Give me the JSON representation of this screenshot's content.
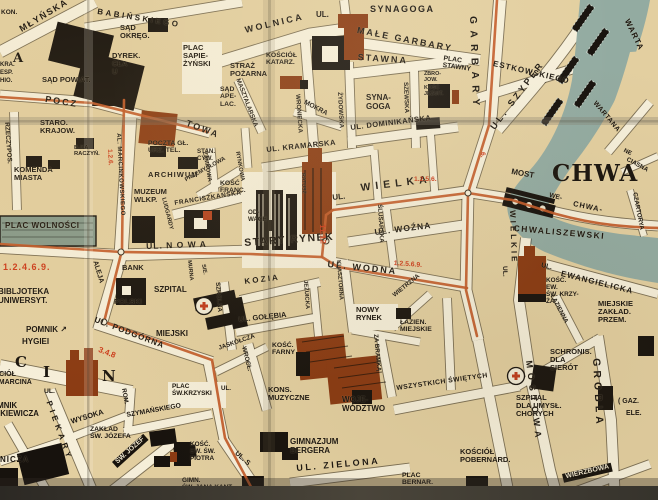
{
  "map": {
    "palette": {
      "paper_block": "#e3cfa0",
      "street": "#f6efda",
      "water": "#93aba1",
      "building_black": "#17120d",
      "landmark_red": "#8a3a12",
      "tram_line_orange": "#c25a28",
      "route_number_red": "#cd3b1a",
      "plac_wolnosci_fill": "#87998a"
    },
    "labels": [
      {
        "t": "KON.",
        "x": 1,
        "y": 9,
        "s": 6.5
      },
      {
        "t": "MŁYŃSKA",
        "x": 18,
        "y": 26,
        "r": -31,
        "s": 9,
        "sp": 1.5
      },
      {
        "t": "BABIŃSKIEGO",
        "x": 98,
        "y": 8,
        "r": 9,
        "s": 8,
        "sp": 2.5
      },
      {
        "t": "A",
        "x": 13,
        "y": 52,
        "s": 13,
        "c": "serif"
      },
      {
        "t": "KRA.",
        "x": 0,
        "y": 62,
        "s": 6
      },
      {
        "t": "ESP.",
        "x": 0,
        "y": 70,
        "s": 6
      },
      {
        "t": "HIO.",
        "x": 0,
        "y": 78,
        "s": 6
      },
      {
        "t": "SĄD\nOKRĘG.",
        "x": 120,
        "y": 24,
        "s": 7.5
      },
      {
        "t": "DYREK.\nCŁA\nU",
        "x": 112,
        "y": 52,
        "s": 7.5
      },
      {
        "t": "PLAC\nSAPIE-\nŻYŃSKI",
        "x": 183,
        "y": 44,
        "s": 7.5
      },
      {
        "t": "SĄD POWIAT.",
        "x": 42,
        "y": 76,
        "s": 7.5
      },
      {
        "t": "POCZ",
        "x": 46,
        "y": 95,
        "r": 9,
        "s": 9,
        "sp": 2
      },
      {
        "t": "TOWA",
        "x": 188,
        "y": 119,
        "r": 21,
        "s": 9,
        "sp": 2
      },
      {
        "t": "RZECZYPOS.",
        "x": 10,
        "y": 122,
        "r": 86,
        "s": 6.5
      },
      {
        "t": "STARO.\nKRAJOW.",
        "x": 40,
        "y": 119,
        "s": 7.5
      },
      {
        "t": "B-KA\nRACZYŃ.",
        "x": 74,
        "y": 145,
        "s": 5.8
      },
      {
        "t": "KOMENDA\nMIASTA",
        "x": 14,
        "y": 166,
        "s": 7.5
      },
      {
        "t": "POCZTA GŁ.\nURZ. TEL.",
        "x": 148,
        "y": 140,
        "s": 6.8
      },
      {
        "t": "STAN.\nCYW.",
        "x": 197,
        "y": 149,
        "s": 6.2
      },
      {
        "t": "ARCHIWUM",
        "x": 148,
        "y": 171,
        "s": 7.5,
        "sp": 1
      },
      {
        "t": "MUZEUM\nWLKP.",
        "x": 134,
        "y": 188,
        "s": 7.5
      },
      {
        "t": "AL. MARCINKOWSKIEGO",
        "x": 121,
        "y": 133,
        "r": 87,
        "s": 6,
        "sp": 0.5
      },
      {
        "t": "1.2.6.",
        "x": 113,
        "y": 149,
        "r": 87,
        "s": 6.5,
        "c": "red"
      },
      {
        "t": "LUDGARDY",
        "x": 166,
        "y": 197,
        "r": 76,
        "s": 5.8
      },
      {
        "t": "ZAMKOWA",
        "x": 207,
        "y": 151,
        "r": 80,
        "s": 5.8
      },
      {
        "t": "RYNKOWA",
        "x": 240,
        "y": 151,
        "r": 80,
        "s": 5.8
      },
      {
        "t": "PRZEMYSŁOWA",
        "x": 184,
        "y": 178,
        "r": -29,
        "s": 5.8
      },
      {
        "t": "FRANCISZKAŃSKA",
        "x": 174,
        "y": 200,
        "r": -9,
        "s": 6.5,
        "sp": 0.5
      },
      {
        "t": "KOŚĆ\nFRANC.",
        "x": 220,
        "y": 180,
        "s": 6.8
      },
      {
        "t": "MURNA",
        "x": 191,
        "y": 260,
        "r": 84,
        "s": 5.5
      },
      {
        "t": "SIE.",
        "x": 205,
        "y": 264,
        "r": 80,
        "s": 5.5
      },
      {
        "t": "UL.",
        "x": 316,
        "y": 11,
        "s": 8
      },
      {
        "t": "SYNAGOGA",
        "x": 370,
        "y": 5,
        "s": 9,
        "sp": 1.5
      },
      {
        "t": "WOLNICA",
        "x": 244,
        "y": 26,
        "r": -13,
        "s": 9,
        "sp": 2.5
      },
      {
        "t": "MAŁE GARBARY",
        "x": 358,
        "y": 26,
        "r": 11,
        "s": 9,
        "sp": 2
      },
      {
        "t": "STAWNA",
        "x": 358,
        "y": 53,
        "r": 4,
        "s": 9,
        "sp": 2
      },
      {
        "t": "PLAC\nSTAWNY",
        "x": 444,
        "y": 55,
        "r": 8,
        "s": 6.8
      },
      {
        "t": "ESTKOWSKIEGO",
        "x": 494,
        "y": 60,
        "r": 13,
        "s": 8,
        "sp": 1
      },
      {
        "t": "UL. SZYPER",
        "x": 489,
        "y": 126,
        "r": -53,
        "s": 9,
        "sp": 3
      },
      {
        "t": "GARBARY",
        "x": 477,
        "y": 16,
        "r": 88,
        "s": 10,
        "sp": 6.5
      },
      {
        "t": "STRAŻ\nPOŻARNA",
        "x": 230,
        "y": 62,
        "s": 7.5
      },
      {
        "t": "KOŚCIÓŁ\nKATARZ.",
        "x": 266,
        "y": 52,
        "s": 6.8
      },
      {
        "t": "SĄD\nAPE-\nLAC.",
        "x": 220,
        "y": 86,
        "s": 6.8
      },
      {
        "t": "MASZTALARSKA",
        "x": 240,
        "y": 78,
        "r": 69,
        "s": 6.2
      },
      {
        "t": "MOKRA",
        "x": 306,
        "y": 99,
        "r": 28,
        "s": 6.8
      },
      {
        "t": "WRONIECKA",
        "x": 300,
        "y": 94,
        "r": 86,
        "s": 6.2
      },
      {
        "t": "ŻYDOWSKA",
        "x": 342,
        "y": 92,
        "r": 87,
        "s": 6.2
      },
      {
        "t": "SZEWSKA",
        "x": 408,
        "y": 82,
        "r": 88,
        "s": 6.2
      },
      {
        "t": "SYNA-\nGOGA",
        "x": 366,
        "y": 94,
        "s": 8
      },
      {
        "t": "ZBRO-\nJOW.",
        "x": 424,
        "y": 72,
        "s": 5.4
      },
      {
        "t": "KOŚĆ\nJEZUIT.",
        "x": 424,
        "y": 86,
        "s": 5.4
      },
      {
        "t": "UL. DOMINIKAŃSKA",
        "x": 350,
        "y": 124,
        "r": -7,
        "s": 7.5,
        "sp": 0.5
      },
      {
        "t": "UL. KRAMARSKA",
        "x": 266,
        "y": 146,
        "r": -6,
        "s": 7.5,
        "sp": 0.5
      },
      {
        "t": "WARTA",
        "x": 630,
        "y": 18,
        "r": 64,
        "s": 8,
        "sp": 1
      },
      {
        "t": "WARTANA",
        "x": 597,
        "y": 100,
        "r": 50,
        "s": 6.8,
        "sp": 0.5
      },
      {
        "t": "NE",
        "x": 625,
        "y": 148,
        "r": 26,
        "s": 6
      },
      {
        "t": "CIASNA",
        "x": 628,
        "y": 157,
        "r": 28,
        "s": 6.2
      },
      {
        "t": "CZARTORYA",
        "x": 637,
        "y": 192,
        "r": 79,
        "s": 6.2
      },
      {
        "t": "6.",
        "x": 486,
        "y": 152,
        "r": 88,
        "s": 6.5,
        "c": "red"
      },
      {
        "t": "UL.",
        "x": 332,
        "y": 194,
        "r": -6,
        "s": 8
      },
      {
        "t": "WIELKA",
        "x": 360,
        "y": 183,
        "r": -7,
        "s": 10.5,
        "sp": 5
      },
      {
        "t": "1.2.5.6.",
        "x": 414,
        "y": 176,
        "s": 6.8,
        "c": "red"
      },
      {
        "t": "MOST",
        "x": 512,
        "y": 168,
        "r": 10,
        "s": 8
      },
      {
        "t": "CHWA",
        "x": 552,
        "y": 162,
        "s": 23,
        "c": "serif"
      },
      {
        "t": "WE-",
        "x": 550,
        "y": 192,
        "r": 14,
        "s": 6.8
      },
      {
        "t": "CHWA-",
        "x": 574,
        "y": 200,
        "r": 12,
        "s": 7.5,
        "sp": 1
      },
      {
        "t": "CHWALISZEWSKI",
        "x": 514,
        "y": 224,
        "r": 5,
        "s": 8.5,
        "sp": 1.5
      },
      {
        "t": "UL. WOŹNA",
        "x": 374,
        "y": 228,
        "r": -7,
        "s": 8.5,
        "sp": 1
      },
      {
        "t": "ŚLUSARSKA",
        "x": 382,
        "y": 204,
        "r": 87,
        "s": 6.2
      },
      {
        "t": "UL. WODNA",
        "x": 328,
        "y": 260,
        "r": 6,
        "s": 9,
        "sp": 2
      },
      {
        "t": "1.2.5.6.9.",
        "x": 394,
        "y": 260,
        "r": 4,
        "s": 6.8,
        "c": "red"
      },
      {
        "t": "STARY RYNEK",
        "x": 244,
        "y": 238,
        "r": -4,
        "s": 10.5,
        "sp": 1.5
      },
      {
        "t": "11.12",
        "x": 326,
        "y": 224,
        "r": 88,
        "s": 8,
        "c": "red"
      },
      {
        "t": "OD-\nWACH",
        "x": 248,
        "y": 210,
        "s": 6.2
      },
      {
        "t": "RATUSZ",
        "x": 305,
        "y": 173,
        "r": 88,
        "s": 5.2
      },
      {
        "t": "UL.",
        "x": 508,
        "y": 266,
        "r": 88,
        "s": 6.5
      },
      {
        "t": "WIELKIE",
        "x": 516,
        "y": 210,
        "r": 88,
        "s": 8,
        "sp": 3
      },
      {
        "t": "KLASZTORNA",
        "x": 341,
        "y": 260,
        "r": 86,
        "s": 5.8
      },
      {
        "t": "K O Z I A",
        "x": 244,
        "y": 278,
        "r": -7,
        "s": 8
      },
      {
        "t": "SZKOLNA",
        "x": 220,
        "y": 282,
        "r": 86,
        "s": 6.2
      },
      {
        "t": "JEZUICKA",
        "x": 308,
        "y": 280,
        "r": 86,
        "s": 5.8
      },
      {
        "t": "UL. GOŁĘBIA",
        "x": 238,
        "y": 316,
        "r": -6,
        "s": 7.5
      },
      {
        "t": "WIETRZNA",
        "x": 392,
        "y": 294,
        "r": -39,
        "s": 6.2
      },
      {
        "t": "NOWY\nRYNEK",
        "x": 356,
        "y": 306,
        "s": 7.5
      },
      {
        "t": "ŁAZIEN.\nMIEJSKIE",
        "x": 400,
        "y": 319,
        "s": 6.8
      },
      {
        "t": "ZA BRAMKĄ",
        "x": 378,
        "y": 334,
        "r": 85,
        "s": 6.2
      },
      {
        "t": "WSZYSTKICH ŚWIĘTYCH",
        "x": 396,
        "y": 385,
        "r": -8,
        "s": 6.8,
        "sp": 0.5
      },
      {
        "t": "WROCŁ.",
        "x": 246,
        "y": 346,
        "r": 76,
        "s": 6.2
      },
      {
        "t": "JASKÓŁCZA",
        "x": 218,
        "y": 346,
        "r": -19,
        "s": 6.2
      },
      {
        "t": "UL.",
        "x": 221,
        "y": 386,
        "s": 6.2
      },
      {
        "t": "KOŚĆ.\nFARNY",
        "x": 272,
        "y": 342,
        "s": 6.8
      },
      {
        "t": "KONS.\nMUZYCZNE",
        "x": 268,
        "y": 386,
        "s": 7.5
      },
      {
        "t": "WOJE-\nWÓDZTWO",
        "x": 342,
        "y": 396,
        "s": 8
      },
      {
        "t": "GIMNAZJUM\nBERGERA",
        "x": 290,
        "y": 438,
        "s": 8
      },
      {
        "t": "UL. ZIELONA",
        "x": 296,
        "y": 464,
        "r": -5,
        "s": 9,
        "sp": 2.5
      },
      {
        "t": "PLAC\nBERNAR.",
        "x": 402,
        "y": 472,
        "s": 6.8
      },
      {
        "t": "KOŚCIÓŁ\nPOBERNARD.",
        "x": 460,
        "y": 448,
        "s": 7.5
      },
      {
        "t": "PLAC WOLNOŚCI",
        "x": 5,
        "y": 222,
        "s": 8,
        "sp": 0.5
      },
      {
        "t": "1.2.4.6.9.",
        "x": 3,
        "y": 263,
        "s": 9,
        "sp": 1,
        "c": "red"
      },
      {
        "t": "BIBLJOTEKA\nUNIWERSYT.",
        "x": -2,
        "y": 288,
        "s": 8
      },
      {
        "t": "POMNIK ↗",
        "x": 26,
        "y": 326,
        "s": 8
      },
      {
        "t": "HYGIEI",
        "x": 22,
        "y": 338,
        "s": 8
      },
      {
        "t": "UL. N O W A",
        "x": 146,
        "y": 242,
        "r": -2,
        "s": 8.5,
        "sp": 1
      },
      {
        "t": "BANK",
        "x": 122,
        "y": 264,
        "s": 7.5
      },
      {
        "t": "POLSKI",
        "x": 114,
        "y": 298,
        "s": 7.5
      },
      {
        "t": "SZPITAL",
        "x": 154,
        "y": 286,
        "s": 8
      },
      {
        "t": "MIEJSKI",
        "x": 156,
        "y": 330,
        "s": 8
      },
      {
        "t": "ALEJA",
        "x": 98,
        "y": 260,
        "r": 73,
        "s": 7
      },
      {
        "t": "UL. PODGÓRNA",
        "x": 96,
        "y": 316,
        "r": 21,
        "s": 8,
        "sp": 1
      },
      {
        "t": "3.4.8",
        "x": 100,
        "y": 346,
        "r": 21,
        "s": 8,
        "c": "red"
      },
      {
        "t": "C",
        "x": 15,
        "y": 354,
        "s": 15,
        "c": "serif"
      },
      {
        "t": "I",
        "x": 43,
        "y": 364,
        "s": 15,
        "c": "serif"
      },
      {
        "t": "N",
        "x": 102,
        "y": 368,
        "s": 15,
        "c": "serif"
      },
      {
        "t": "KOŚCIÓŁ\nŚW. MARCINA",
        "x": -16,
        "y": 371,
        "s": 7
      },
      {
        "t": "POMNIK\nMICKIEWICZA",
        "x": -14,
        "y": 402,
        "s": 7.8
      },
      {
        "t": "NICZA",
        "x": 0,
        "y": 456,
        "s": 8,
        "sp": 1
      },
      {
        "t": "UL.",
        "x": 44,
        "y": 388,
        "s": 6.8
      },
      {
        "t": "PIEKARY",
        "x": 52,
        "y": 400,
        "r": 70,
        "s": 8,
        "sp": 4
      },
      {
        "t": "WYSOKA",
        "x": 70,
        "y": 418,
        "r": -17,
        "s": 7.5
      },
      {
        "t": "ROM.",
        "x": 126,
        "y": 388,
        "r": 80,
        "s": 6.2
      },
      {
        "t": "SZYMAŃSKIEGO",
        "x": 126,
        "y": 412,
        "r": -10,
        "s": 6.8
      },
      {
        "t": "ZAKŁAD\nŚW. JÓZEFA",
        "x": 90,
        "y": 426,
        "s": 6.8
      },
      {
        "t": "ŚW. JÓZEF",
        "x": 112,
        "y": 462,
        "r": -42,
        "s": 6.8,
        "c": "onblack"
      },
      {
        "t": "PLAC\nŚW.KRZYSKI",
        "x": 172,
        "y": 384,
        "s": 6.4
      },
      {
        "t": "KOŚĆ.\nEW. ŚW.\nPIOTRA",
        "x": 190,
        "y": 442,
        "s": 6.4
      },
      {
        "t": "GIMN.\nŚW. JANA KANT.",
        "x": 182,
        "y": 478,
        "s": 6.4
      },
      {
        "t": "UL. S",
        "x": 238,
        "y": 450,
        "r": 42,
        "s": 7
      },
      {
        "t": "KOŚC.\nEW.\nŚW. KRZY-\nŻA",
        "x": 546,
        "y": 278,
        "s": 6.4
      },
      {
        "t": "UL.",
        "x": 542,
        "y": 262,
        "r": 13,
        "s": 6.8
      },
      {
        "t": "EWANGIELICKA",
        "x": 562,
        "y": 270,
        "r": 14,
        "s": 8,
        "sp": 1
      },
      {
        "t": "ŁAZIENNA",
        "x": 554,
        "y": 294,
        "r": 62,
        "s": 6.2
      },
      {
        "t": "MIEJSKIE\nZAKŁAD.\nPRZEM.",
        "x": 598,
        "y": 300,
        "s": 7.5
      },
      {
        "t": "SCHRONIS.\nDLA\nSIERÓT",
        "x": 550,
        "y": 348,
        "s": 7.5
      },
      {
        "t": "SZPITAL\nDLA UMYSŁ.\nCHORYCH",
        "x": 516,
        "y": 394,
        "s": 7.5
      },
      {
        "t": "GROBLA",
        "x": 601,
        "y": 358,
        "r": 87,
        "s": 10.5,
        "sp": 4
      },
      {
        "t": "MOSTOWA",
        "x": 533,
        "y": 360,
        "r": 83,
        "s": 9,
        "sp": 5
      },
      {
        "t": "WIERZBOWA",
        "x": 562,
        "y": 474,
        "r": -13,
        "s": 7,
        "c": "onblack"
      },
      {
        "t": "( GAZ.",
        "x": 618,
        "y": 398,
        "s": 7
      },
      {
        "t": "ELE.",
        "x": 626,
        "y": 410,
        "s": 7
      }
    ]
  }
}
